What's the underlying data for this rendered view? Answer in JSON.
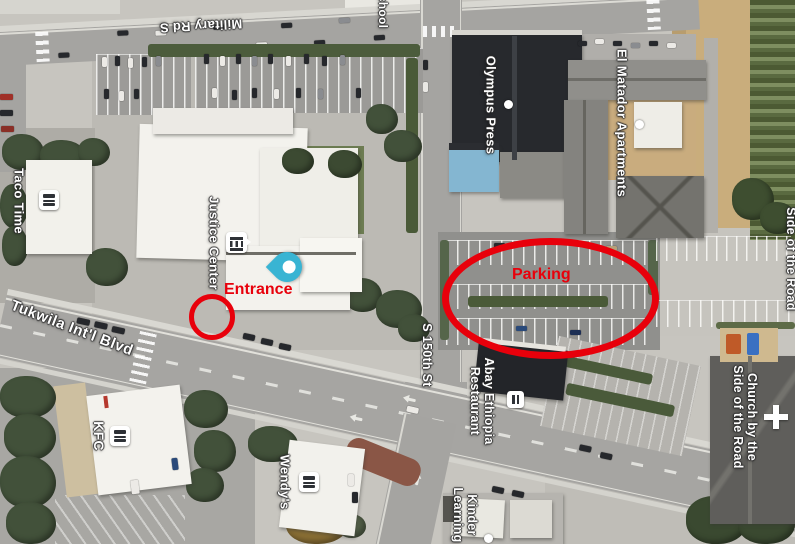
{
  "map_labels": {
    "military_rd": "Military Rd S",
    "school": "school",
    "taco_time": "Taco Time",
    "justice_center": "Justice Center",
    "tukwila_blvd": "Tukwila Int'l Blvd",
    "kfc": "KFC",
    "wendys": "Wendy's",
    "olympus_press": "Olympus Press",
    "el_matador": "El Matador Apartments",
    "s_150th_st": "S 150th St",
    "abay_ethiopia": {
      "line1": "Abay Ethiopia",
      "line2": "Restaurant"
    },
    "kinder_learning": {
      "line1": "Kinder",
      "line2": "Learning"
    },
    "church": {
      "line1": "Church by the",
      "line2": "Side of the Road"
    },
    "side_of_the_road": "Side of the Road"
  },
  "annotations": {
    "entrance_label": "Entrance",
    "parking_label": "Parking",
    "color": "#e8000b"
  },
  "icons": {
    "taco_time_poi": "restaurant-burger-icon",
    "kfc_poi": "restaurant-burger-icon",
    "wendys_poi": "restaurant-burger-icon",
    "justice_center_poi": "government-building-icon",
    "abay_poi": "restaurant-icon",
    "olympus_press_poi": "dot-icon",
    "el_matador_poi": "dot-icon",
    "kinder_poi": "dot-icon",
    "church_poi": "cross-icon",
    "entrance_pin": "location-pin-icon",
    "pin_color": "#39b4d3"
  }
}
